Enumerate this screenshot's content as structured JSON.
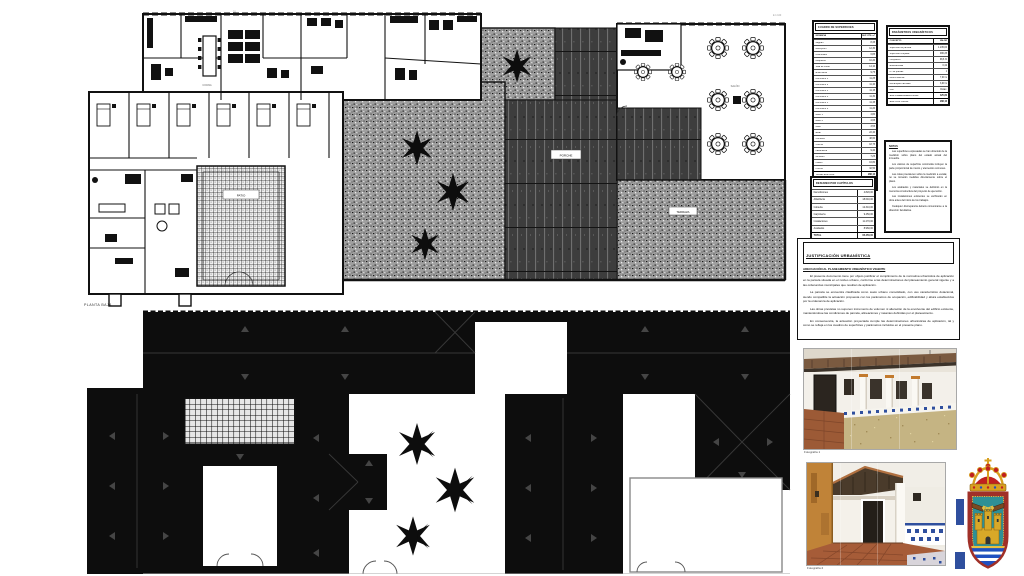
{
  "plan_labels": {
    "floor_caption": "PLANTA BAJA",
    "patio": "PATIO",
    "porche": "PORCHE",
    "terraza": "TERRAZA",
    "salon": "SALÓN",
    "cocina": "COCINA",
    "note_left": "03",
    "note_right": "E 1:100"
  },
  "tables": {
    "surfaces": {
      "title": "CUADRO DE SUPERFICIES",
      "col_name": "ESTANCIA",
      "col_value": "SUP. ÚTIL m²",
      "rows": [
        {
          "label": "Zaguán",
          "value": "8,45"
        },
        {
          "label": "Recepción",
          "value": "12,30"
        },
        {
          "label": "Distribuidor",
          "value": "6,85"
        },
        {
          "label": "Despacho",
          "value": "10,20"
        },
        {
          "label": "Sala de curas",
          "value": "14,10"
        },
        {
          "label": "Enfermería",
          "value": "9,75"
        },
        {
          "label": "Dormitorio 1",
          "value": "11,25"
        },
        {
          "label": "Dormitorio 2",
          "value": "11,40"
        },
        {
          "label": "Dormitorio 3",
          "value": "11,15"
        },
        {
          "label": "Dormitorio 4",
          "value": "11,30"
        },
        {
          "label": "Dormitorio 5",
          "value": "11,45"
        },
        {
          "label": "Dormitorio 6",
          "value": "11,20"
        },
        {
          "label": "Baño 1",
          "value": "4,80"
        },
        {
          "label": "Baño 2",
          "value": "4,65"
        },
        {
          "label": "Aseo",
          "value": "3,55"
        },
        {
          "label": "Estar",
          "value": "22,40"
        },
        {
          "label": "Comedor",
          "value": "48,60"
        },
        {
          "label": "Cocina",
          "value": "18,75"
        },
        {
          "label": "Lavandería",
          "value": "9,40"
        },
        {
          "label": "Almacén",
          "value": "7,25"
        },
        {
          "label": "Pasillo",
          "value": "16,80"
        },
        {
          "label": "Porche",
          "value": "32,50"
        }
      ],
      "totals": [
        {
          "label": "TOTAL SUP. ÚTIL",
          "value": "288,10"
        },
        {
          "label": "SUP. CONSTRUIDA",
          "value": "392,45"
        },
        {
          "label": "TOTAL CONSTRUIDA",
          "value": "425,80"
        }
      ]
    },
    "parameters": {
      "title": "PARÁMETROS URBANÍSTICOS",
      "col_name": "CONCEPTO",
      "col_value": "VALOR",
      "rows": [
        {
          "label": "Superficie de parcela",
          "value": "1.245,00"
        },
        {
          "label": "Superficie ocupada",
          "value": "480,25"
        },
        {
          "label": "Ocupación",
          "value": "38,6 %"
        },
        {
          "label": "Edificabilidad",
          "value": "0,42"
        },
        {
          "label": "Nº de plantas",
          "value": "1"
        },
        {
          "label": "Altura máxima",
          "value": "7,00 m"
        },
        {
          "label": "Retranqueo fachada",
          "value": "3,00 m"
        },
        {
          "label": "Uso",
          "value": "Dotac."
        }
      ],
      "totals": [
        {
          "label": "SUP. CONSTRUIDA TOTAL",
          "value": "425,80"
        },
        {
          "label": "SUP. ÚTIL TOTAL",
          "value": "288,10"
        }
      ]
    },
    "budget": {
      "title": "RESUMEN POR CAPÍTULOS",
      "rows": [
        {
          "label": "Demoliciones",
          "value": "4.820,00"
        },
        {
          "label": "Albañilería",
          "value": "18.640,00"
        },
        {
          "label": "Cubierta",
          "value": "12.310,00"
        },
        {
          "label": "Carpintería",
          "value": "9.450,00"
        },
        {
          "label": "Instalaciones",
          "value": "11.270,00"
        },
        {
          "label": "Acabados",
          "value": "8.960,00"
        }
      ],
      "totals": [
        {
          "label": "TOTAL",
          "value": "65.450,00"
        }
      ]
    }
  },
  "note_block": {
    "title": "NOTAS",
    "paragraphs": [
      "Las superficies expresadas se han obtenido de la medición sobre plano del estado actual del inmueble.",
      "Los valores de superficie construida incluyen la parte proporcional de muros y elementos comunes.",
      "Las cotas prevalecen sobre la medición a escala; no se tomarán medidas directamente sobre el plano.",
      "Los acabados y materiales se definirán en la memoria constructiva del proyecto de ejecución.",
      "Las instalaciones existentes se verificarán en obra antes del inicio de los trabajos.",
      "Cualquier discrepancia deberá comunicarse a la dirección facultativa."
    ]
  },
  "certification": {
    "title": "JUSTIFICACIÓN URBANÍSTICA",
    "subtitle": "ADECUACIÓN AL PLANEAMIENTO URBANÍSTICO VIGENTE",
    "paragraphs": [
      "El presente documento tiene por objeto justificar el cumplimiento de la normativa urbanística de aplicación en la parcela situada en el núcleo urbano, conforme a las determinaciones del planeamiento general vigente y a las ordenanzas municipales que resultan de aplicación.",
      "La parcela se encuentra clasificada como suelo urbano consolidado, con uso característico dotacional, siendo compatible la actuación propuesta con los parámetros de ocupación, edificabilidad y altura establecidos por la ordenanza de aplicación.",
      "Las obras previstas no suponen incremento de volumen ni alteración de la envolvente del edificio existente, manteniéndose las condiciones de parcela, alineaciones y rasantes definidas por el planeamiento.",
      "En consecuencia, la actuación proyectada cumple las determinaciones urbanísticas de aplicación, tal y como se refleja en los cuadros de superficies y parámetros incluidos en el presente plano."
    ]
  },
  "photos": {
    "caption_1": "Fotografía 1",
    "caption_2": "Fotografía 2"
  },
  "colors": {
    "plan_black": "#0d0d0d",
    "crest_red": "#a03028",
    "crest_teal": "#2e9096",
    "crest_gold": "#d8a828",
    "tile_blue": "#2f4f9e",
    "terracotta": "#9c5a36"
  }
}
